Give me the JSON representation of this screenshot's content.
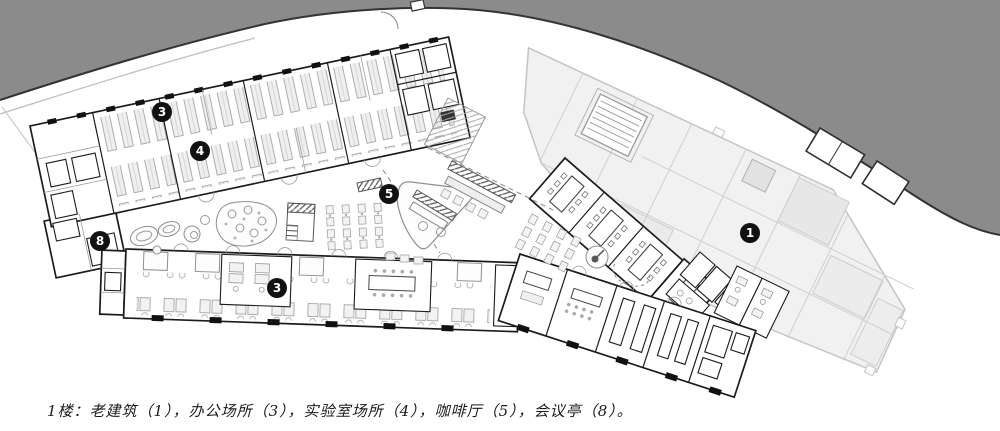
{
  "meta": {
    "type": "architectural floor plan",
    "floor": "1F"
  },
  "caption": {
    "text": "1楼：老建筑（1），办公场所（3），实验室场所（4），咖啡厅（5），会议亭（8）。"
  },
  "legend": [
    {
      "num": "1",
      "name": "老建筑"
    },
    {
      "num": "3",
      "name": "办公场所"
    },
    {
      "num": "4",
      "name": "实验室场所"
    },
    {
      "num": "5",
      "name": "咖啡厅"
    },
    {
      "num": "8",
      "name": "会议亭"
    }
  ],
  "markers": [
    {
      "num": "3",
      "name": "办公场所",
      "x": 162,
      "y": 112
    },
    {
      "num": "4",
      "name": "实验室场所",
      "x": 200,
      "y": 151
    },
    {
      "num": "5",
      "name": "咖啡厅",
      "x": 389,
      "y": 194
    },
    {
      "num": "8",
      "name": "会议亭",
      "x": 100,
      "y": 241
    },
    {
      "num": "3",
      "name": "办公场所",
      "x": 277,
      "y": 288
    },
    {
      "num": "1",
      "name": "老建筑",
      "x": 750,
      "y": 233
    }
  ],
  "colors": {
    "road": "#8b8b8b",
    "road_edge": "#333333",
    "wall": "#1c1c1c",
    "old_line": "#c4c4c4",
    "old_fill": "#f1f1f1",
    "marker_bg": "#111111",
    "marker_text": "#ffffff",
    "bg": "#ffffff"
  }
}
